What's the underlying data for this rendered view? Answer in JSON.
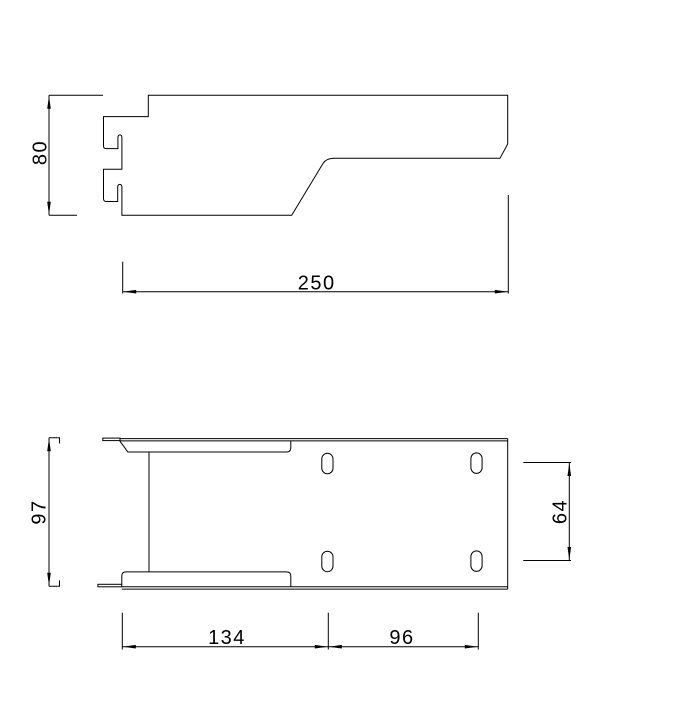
{
  "drawing": {
    "background": "#ffffff",
    "line_color": "#000000",
    "views": {
      "side": {
        "title": "side-profile-view",
        "dimensions": {
          "height": {
            "value": "80"
          },
          "length": {
            "value": "250"
          }
        }
      },
      "plan": {
        "title": "plan-view",
        "slot_count": 4,
        "dimensions": {
          "width": {
            "value": "97"
          },
          "slot_spacing": {
            "value": "64"
          },
          "edge_to_slot": {
            "value": "134"
          },
          "slot_pitch": {
            "value": "96"
          }
        }
      }
    }
  }
}
